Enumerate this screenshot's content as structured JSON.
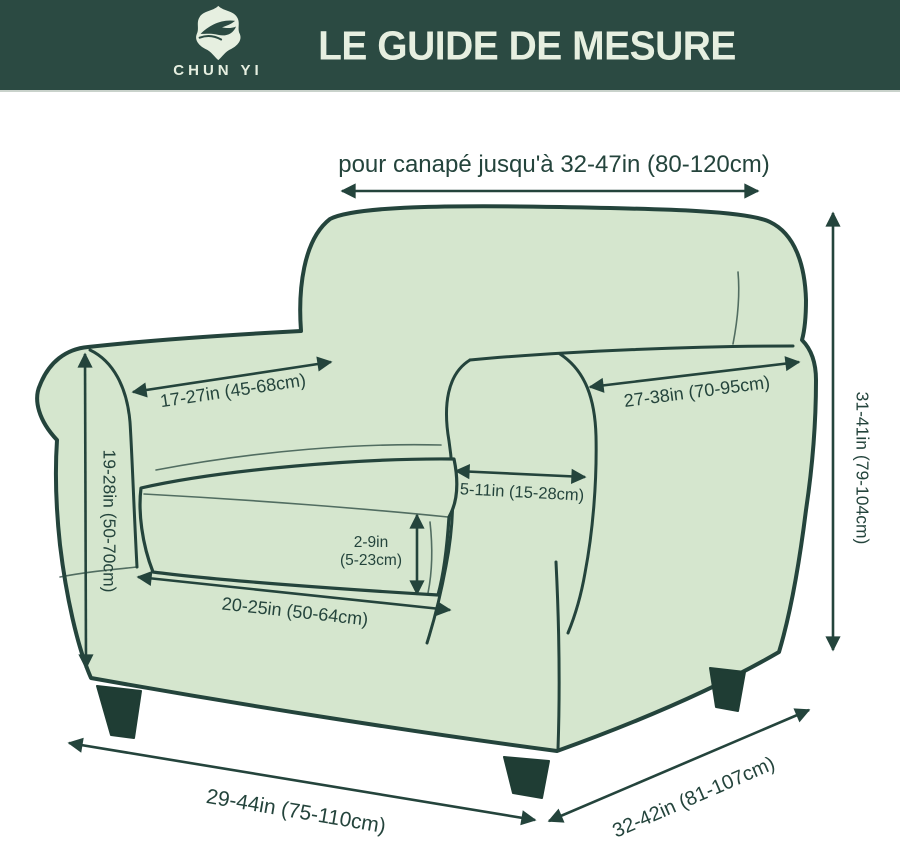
{
  "header": {
    "brand": "CHUN YI",
    "title": "LE GUIDE DE MESURE"
  },
  "measurements": {
    "sofa_range": "pour canapé jusqu'à 32-47in (80-120cm)",
    "back_width": "17-27in (45-68cm)",
    "arm_top_length": "27-38in (70-95cm)",
    "arm_height": "19-28in (50-70cm)",
    "arm_width": "5-11in (15-28cm)",
    "cushion_height_line1": "2-9in",
    "cushion_height_line2": "(5-23cm)",
    "seat_width": "20-25in (50-64cm)",
    "total_height": "31-41in (79-104cm)",
    "base_width": "29-44in (75-110cm)",
    "base_depth": "32-42in (81-107cm)"
  },
  "colors": {
    "banner_bg": "#2b4a42",
    "banner_text": "#e6efe0",
    "chair_fill": "#d5e6ce",
    "line": "#24443c",
    "leg_fill": "#1f3d34"
  }
}
